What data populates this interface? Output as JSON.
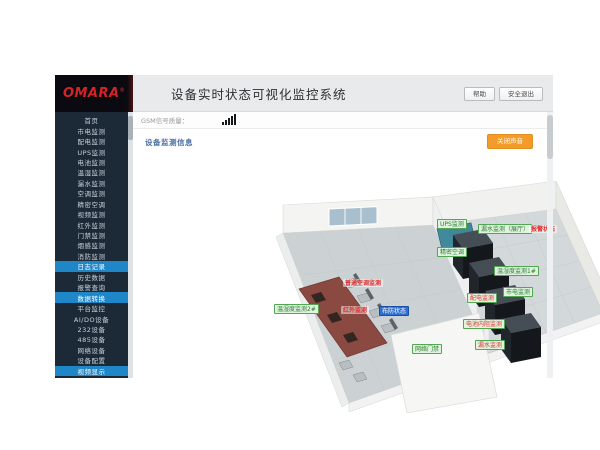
{
  "colors": {
    "sidebar_bg": "#1c2a38",
    "active_item": "#1f86c8",
    "logo_red": "#d42427",
    "header_bg": "#e9eaeb",
    "accent_orange": "#f39c2c",
    "section_title_blue": "#4a6fa5",
    "label_green_bg": "#dff3df",
    "label_green_border": "#53a653",
    "label_green_text": "#2e7d32",
    "alarm_red": "#e03030",
    "armed_blue": "#2f6fd0"
  },
  "logo": {
    "brand": "OMARA",
    "registered_mark": "®"
  },
  "header": {
    "title": "设备实时状态可视化监控系统",
    "buttons": [
      {
        "label": "帮助"
      },
      {
        "label": "安全退出"
      }
    ]
  },
  "statusbar": {
    "gsm_label": "GSM信号质量：",
    "signal_icon": "signal-strength-bars"
  },
  "content": {
    "section_title": "设备监测信息",
    "sound_button_label": "关闭声音"
  },
  "sidebar": {
    "items": [
      {
        "label": "首页",
        "active": false
      },
      {
        "label": "市电监测",
        "active": false
      },
      {
        "label": "配电监测",
        "active": false
      },
      {
        "label": "UPS监测",
        "active": false
      },
      {
        "label": "电池监测",
        "active": false
      },
      {
        "label": "温湿监测",
        "active": false
      },
      {
        "label": "漏水监测",
        "active": false
      },
      {
        "label": "空调监测",
        "active": false
      },
      {
        "label": "精密空调",
        "active": false
      },
      {
        "label": "视频监测",
        "active": false
      },
      {
        "label": "红外监测",
        "active": false
      },
      {
        "label": "门禁监测",
        "active": false
      },
      {
        "label": "烟感监测",
        "active": false
      },
      {
        "label": "消防监测",
        "active": false
      },
      {
        "label": "日志记录",
        "active": true
      },
      {
        "label": "历史数据",
        "active": false
      },
      {
        "label": "报警查询",
        "active": false
      },
      {
        "label": "数据转换",
        "active": true
      },
      {
        "label": "平台监控",
        "active": false
      },
      {
        "label": "AI/DO设备",
        "active": false
      },
      {
        "label": "232设备",
        "active": false
      },
      {
        "label": "485设备",
        "active": false
      },
      {
        "label": "网络设备",
        "active": false
      },
      {
        "label": "设备配置",
        "active": false
      },
      {
        "label": "视频显示",
        "active": true
      }
    ]
  },
  "scene": {
    "labels": [
      {
        "id": "ups",
        "text": "UPS监测",
        "variant": "green"
      },
      {
        "id": "leak_hall",
        "text": "漏水监测（展厅）",
        "variant": "green"
      },
      {
        "id": "leak_hall_alarm",
        "text": "报警状态",
        "variant": "red-text"
      },
      {
        "id": "precision_ac",
        "text": "精密空调",
        "variant": "green"
      },
      {
        "id": "temp1",
        "text": "温湿度监测1#",
        "variant": "green"
      },
      {
        "id": "mains",
        "text": "市电监测",
        "variant": "green"
      },
      {
        "id": "dist",
        "text": "配电监测",
        "variant": "green-alarm"
      },
      {
        "id": "battery",
        "text": "电池内阻监测",
        "variant": "green-alarm"
      },
      {
        "id": "leak2",
        "text": "漏水监测",
        "variant": "green-alarm"
      },
      {
        "id": "temp2",
        "text": "温湿度监测2#",
        "variant": "green"
      },
      {
        "id": "normal_ac",
        "text": "普通空调监测",
        "variant": "red-text"
      },
      {
        "id": "infrared",
        "text": "红外监测",
        "variant": "red-text"
      },
      {
        "id": "armed",
        "text": "布防状态",
        "variant": "blue"
      },
      {
        "id": "door",
        "text": "网络门禁",
        "variant": "green"
      }
    ]
  }
}
